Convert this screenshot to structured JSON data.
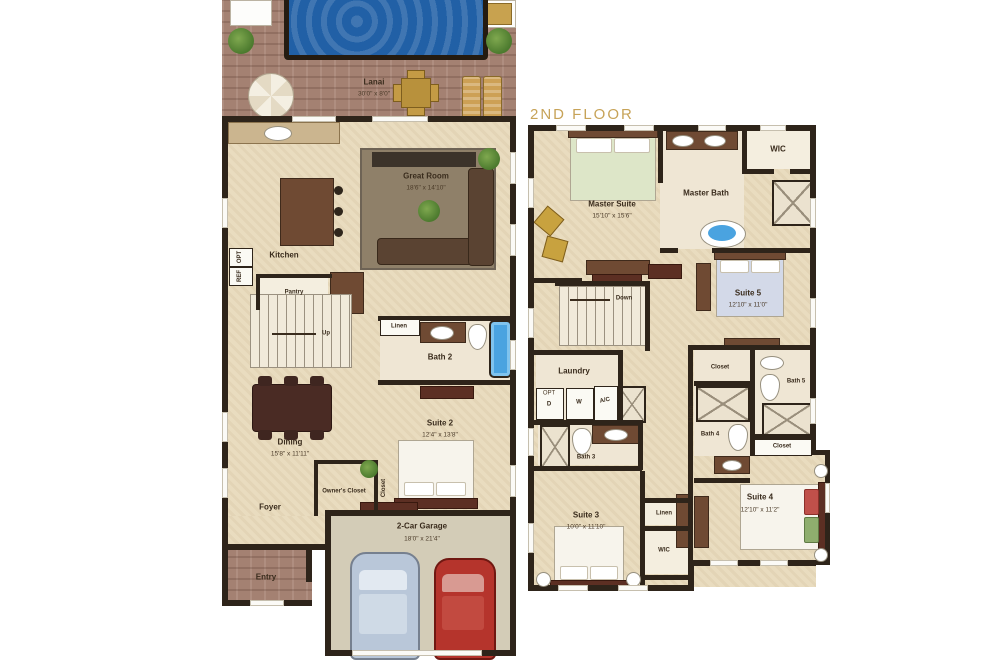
{
  "colors": {
    "accent_gold": "#C7A358",
    "wall": "#2E241A",
    "floor_tan": "#E9DCBF",
    "pool_blue": "#2160A6",
    "brick": "#A48172",
    "carpet": "#8F8069",
    "garage_floor": "#D3CCB7",
    "tub_blue": "#4AA3E0"
  },
  "floor1": {
    "lanai": {
      "name": "Lanai",
      "dims": "30'0\" x 8'0\""
    },
    "great_room": {
      "name": "Great Room",
      "dims": "18'6\" x 14'10\""
    },
    "kitchen": {
      "name": "Kitchen"
    },
    "pantry": {
      "name": "Pantry"
    },
    "up": {
      "name": "Up"
    },
    "linen": {
      "name": "Linen"
    },
    "bath2": {
      "name": "Bath 2"
    },
    "dining": {
      "name": "Dining",
      "dims": "15'8\" x 11'11\""
    },
    "suite2": {
      "name": "Suite 2",
      "dims": "12'4\" x 13'8\""
    },
    "owners_closet": {
      "name": "Owner's Closet"
    },
    "closet": {
      "name": "Closet"
    },
    "foyer": {
      "name": "Foyer"
    },
    "entry": {
      "name": "Entry"
    },
    "garage": {
      "name": "2-Car Garage",
      "dims": "18'0\" x 21'4\""
    },
    "opt": "OPT",
    "ref": "REF"
  },
  "floor2": {
    "label": "2ND FLOOR",
    "master_suite": {
      "name": "Master Suite",
      "dims": "15'10\" x 15'6\""
    },
    "master_bath": {
      "name": "Master Bath"
    },
    "wic_top": {
      "name": "WIC"
    },
    "suite5": {
      "name": "Suite 5",
      "dims": "12'10\" x 11'0\""
    },
    "down": {
      "name": "Down"
    },
    "laundry": {
      "name": "Laundry"
    },
    "dryer": "D",
    "washer": "W",
    "opt": "OPT",
    "ac": "A/C",
    "bath3": {
      "name": "Bath 3"
    },
    "closet_top": {
      "name": "Closet"
    },
    "bath5": {
      "name": "Bath 5"
    },
    "bath4": {
      "name": "Bath 4"
    },
    "linen_side": {
      "name": "Linen"
    },
    "closet_bottom": {
      "name": "Closet"
    },
    "suite3": {
      "name": "Suite 3",
      "dims": "10'0\" x 11'10\""
    },
    "linen_mid": {
      "name": "Linen"
    },
    "wic_bottom": {
      "name": "WIC"
    },
    "suite4": {
      "name": "Suite 4",
      "dims": "12'10\" x 11'2\""
    }
  }
}
